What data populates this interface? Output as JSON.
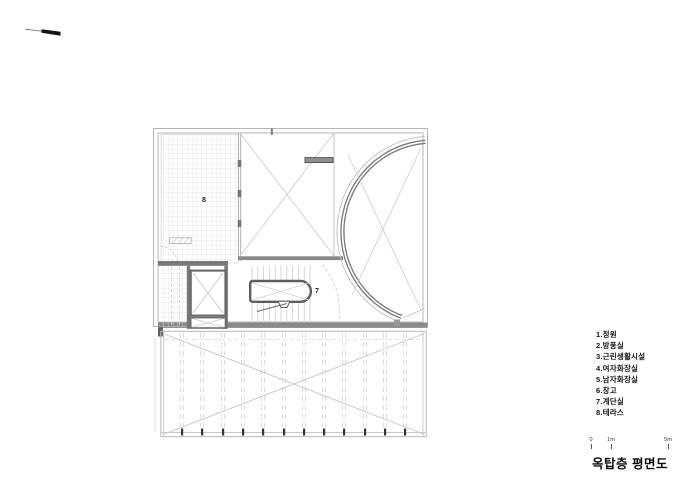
{
  "icons": {
    "north_arrow": "north-arrow-icon"
  },
  "plan": {
    "room_labels": {
      "terrace": "8",
      "stair": "7"
    }
  },
  "legend": {
    "items": [
      "1.정원",
      "2.방풍실",
      "3.근린생활시설",
      "4.여자화장실",
      "5.남자화장실",
      "6.창고",
      "7.계단실",
      "8.테라스"
    ]
  },
  "scale_bar": {
    "ticks": [
      "0",
      "1m",
      "5m"
    ]
  },
  "title": {
    "text": "옥탑층 평면도"
  },
  "colors": {
    "background": "#ffffff",
    "line_light": "#b5b5b5",
    "line_detail": "#cccccc",
    "wall_dark": "#6f6f6f",
    "text": "#111111"
  }
}
